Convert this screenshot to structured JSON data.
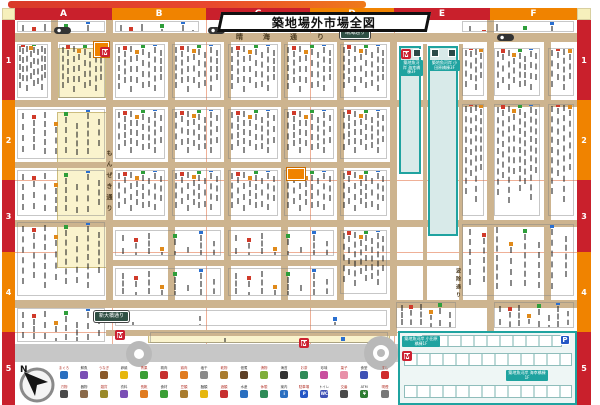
{
  "title": "築地場外市場全図",
  "grid": {
    "columns": [
      "A",
      "B",
      "C",
      "D",
      "E",
      "F"
    ],
    "rows": [
      "1",
      "2",
      "3",
      "4",
      "5"
    ]
  },
  "streets": {
    "harumi": "晴海通り",
    "harumi_plate": "晴海通り",
    "monzeki": "もんぜき通り",
    "namiyoke": "波除通り",
    "shinohashi_plate": "新大橋通り"
  },
  "buildings": {
    "uogashi_kaiko_3f": "築地魚河岸 海幸橋棟3F",
    "uogashi_odawara_3f": "築地魚河岸 小田原橋棟3F",
    "uogashi_odawara_1f": "築地魚河岸 小田原橋棟1F",
    "uogashi_kaiko_1f": "築地魚河岸 海幸橋棟1F"
  },
  "markers": {
    "metro": "M",
    "parking": "P",
    "north": "N"
  },
  "legend": {
    "row1": [
      {
        "label": "まぐろ",
        "color": "#2a6fc0"
      },
      {
        "label": "鮮魚",
        "color": "#7a4fb5"
      },
      {
        "label": "うなぎ",
        "color": "#8a5a2a"
      },
      {
        "label": "卵焼",
        "color": "#e6b70e"
      },
      {
        "label": "青果",
        "color": "#3a9e35"
      },
      {
        "label": "精肉",
        "color": "#c73030"
      },
      {
        "label": "鶏肉",
        "color": "#e07b1f"
      },
      {
        "label": "塩干",
        "color": "#8a8a8a"
      },
      {
        "label": "乾物",
        "color": "#a97c2f"
      },
      {
        "label": "佃煮",
        "color": "#5d4027"
      },
      {
        "label": "漬物",
        "color": "#7fae3a"
      },
      {
        "label": "海苔",
        "color": "#333333"
      },
      {
        "label": "お茶",
        "color": "#2e8b57"
      },
      {
        "label": "珍味",
        "color": "#c94f9e"
      },
      {
        "label": "菓子",
        "color": "#e890a8"
      },
      {
        "label": "食堂",
        "color": "#3f51b5"
      },
      {
        "label": "すし",
        "color": "#d02b2b"
      }
    ],
    "row2": [
      {
        "label": "刃物",
        "color": "#4a4a4a"
      },
      {
        "label": "器物",
        "color": "#8a6a4a"
      },
      {
        "label": "雑貨",
        "color": "#9a8a2a"
      },
      {
        "label": "衣料",
        "color": "#7a4fb5"
      },
      {
        "label": "長靴",
        "color": "#e07b1f"
      },
      {
        "label": "食材",
        "color": "#3a9e35"
      },
      {
        "label": "豆類",
        "color": "#a97c2f"
      },
      {
        "label": "麺類",
        "color": "#e6b70e"
      },
      {
        "label": "酒類",
        "color": "#c73030"
      },
      {
        "label": "水産",
        "color": "#2a6fc0"
      },
      {
        "label": "休憩",
        "color": "#2e8b57"
      },
      {
        "label": "案内",
        "color": "#2a6fc0",
        "glyph": "i"
      },
      {
        "label": "駐車場",
        "color": "#2457c5",
        "glyph": "P"
      },
      {
        "label": "トイレ",
        "color": "#3f51b5",
        "glyph": "WC"
      },
      {
        "label": "交番",
        "color": "#4a4a4a"
      },
      {
        "label": "ATM",
        "color": "#2e7d32",
        "glyph": "¥"
      },
      {
        "label": "喫煙",
        "color": "#777777"
      }
    ]
  }
}
